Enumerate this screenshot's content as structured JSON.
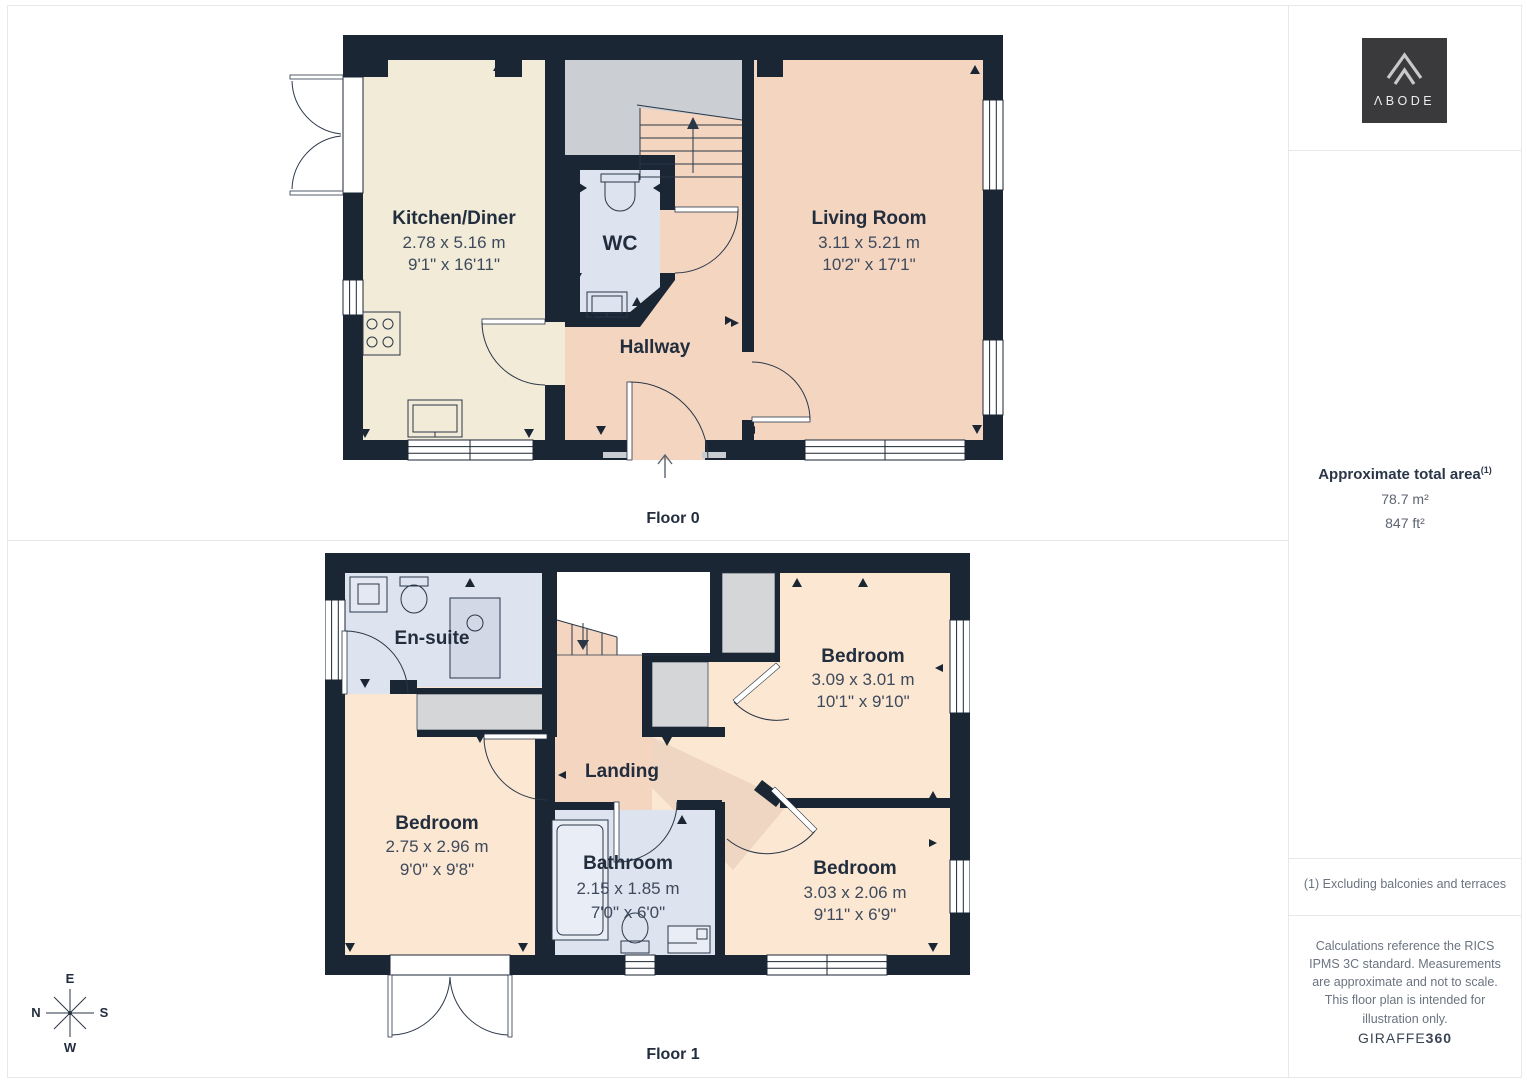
{
  "floor0": {
    "label": "Floor 0",
    "rooms": {
      "kitchen": {
        "name": "Kitchen/Diner",
        "metric": "2.78 x 5.16 m",
        "imperial": "9'1\" x 16'11\""
      },
      "wc": {
        "name": "WC"
      },
      "hallway": {
        "name": "Hallway"
      },
      "living": {
        "name": "Living Room",
        "metric": "3.11 x 5.21 m",
        "imperial": "10'2\" x 17'1\""
      }
    }
  },
  "floor1": {
    "label": "Floor 1",
    "rooms": {
      "ensuite": {
        "name": "En-suite"
      },
      "bedroom_left": {
        "name": "Bedroom",
        "metric": "2.75 x 2.96 m",
        "imperial": "9'0\" x 9'8\""
      },
      "bathroom": {
        "name": "Bathroom",
        "metric": "2.15 x 1.85 m",
        "imperial": "7'0\" x 6'0\""
      },
      "landing": {
        "name": "Landing"
      },
      "bedroom_top_right": {
        "name": "Bedroom",
        "metric": "3.09 x 3.01 m",
        "imperial": "10'1\" x 9'10\""
      },
      "bedroom_bottom_right": {
        "name": "Bedroom",
        "metric": "3.03 x 2.06 m",
        "imperial": "9'11\" x 6'9\""
      }
    }
  },
  "sidebar": {
    "logo_text": "ΛBODE",
    "area_title": "Approximate total area",
    "area_footnote_marker": "(1)",
    "area_m2": "78.7 m²",
    "area_ft2": "847 ft²",
    "note": "(1) Excluding balconies and terraces",
    "disclaimer": "Calculations reference the RICS IPMS 3C standard. Measurements are approximate and not to scale. This floor plan is intended for illustration only.",
    "credit_brand": "GIRAFFE",
    "credit_suffix": "360"
  },
  "compass": {
    "north": "N",
    "east": "E",
    "south": "S",
    "west": "W"
  },
  "colors": {
    "wall": "#1b2634",
    "kitchen_floor": "#f1ebd8",
    "living_floor": "#f4d5c0",
    "bedroom_floor": "#fbe7d2",
    "bathroom_floor": "#dde3ef",
    "stair_gray": "#cbced2",
    "closet_gray": "#d4d6d8",
    "landing_shade": "#eed6c3"
  }
}
